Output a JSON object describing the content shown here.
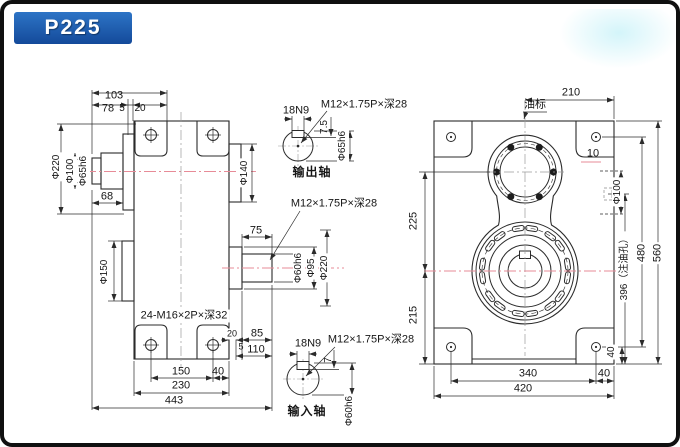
{
  "badge": {
    "label": "P225"
  },
  "side_view": {
    "top_dims": {
      "total": "103",
      "a": "78",
      "b": "5",
      "c": "20"
    },
    "left": {
      "phi220": "Φ220",
      "phi100": "Φ100",
      "phi65": "Φ65h6",
      "len68": "68",
      "phi150": "Φ150"
    },
    "right": {
      "phi140": "Φ140",
      "len75": "75",
      "phi60": "Φ60h6",
      "phi95": "Φ95",
      "phi220": "Φ220",
      "thread": "M12×1.75P×深28"
    },
    "thread_note": "24-M16×2P×深32",
    "bottom_dims": {
      "feet": "150",
      "offset": "40",
      "body": "230",
      "total": "443",
      "s20": "20",
      "s85": "85",
      "s5": "5",
      "s110": "110"
    }
  },
  "output_shaft": {
    "key": "18N9",
    "thread": "M12×1.75P×深28",
    "depth": "7.5",
    "dia": "Φ65h6",
    "caption": "输出轴"
  },
  "input_shaft": {
    "key": "18N9",
    "thread": "M12×1.75P×深28",
    "depth": "7",
    "dia": "Φ60h6",
    "caption": "输入轴"
  },
  "front_view": {
    "top": "210",
    "oil_gauge": "油标",
    "d10": "10",
    "phi100": "Φ100",
    "oil_hole": "396（注油孔）",
    "holes_v": "480",
    "height": "560",
    "d40_side": "40",
    "upper": "225",
    "lower": "215",
    "holes_h": "340",
    "d40_bottom": "40",
    "width": "420"
  },
  "colors": {
    "badge_blue": "#1d5cab",
    "line": "#2b2b2b",
    "centerline_pink": "#e78b97"
  }
}
